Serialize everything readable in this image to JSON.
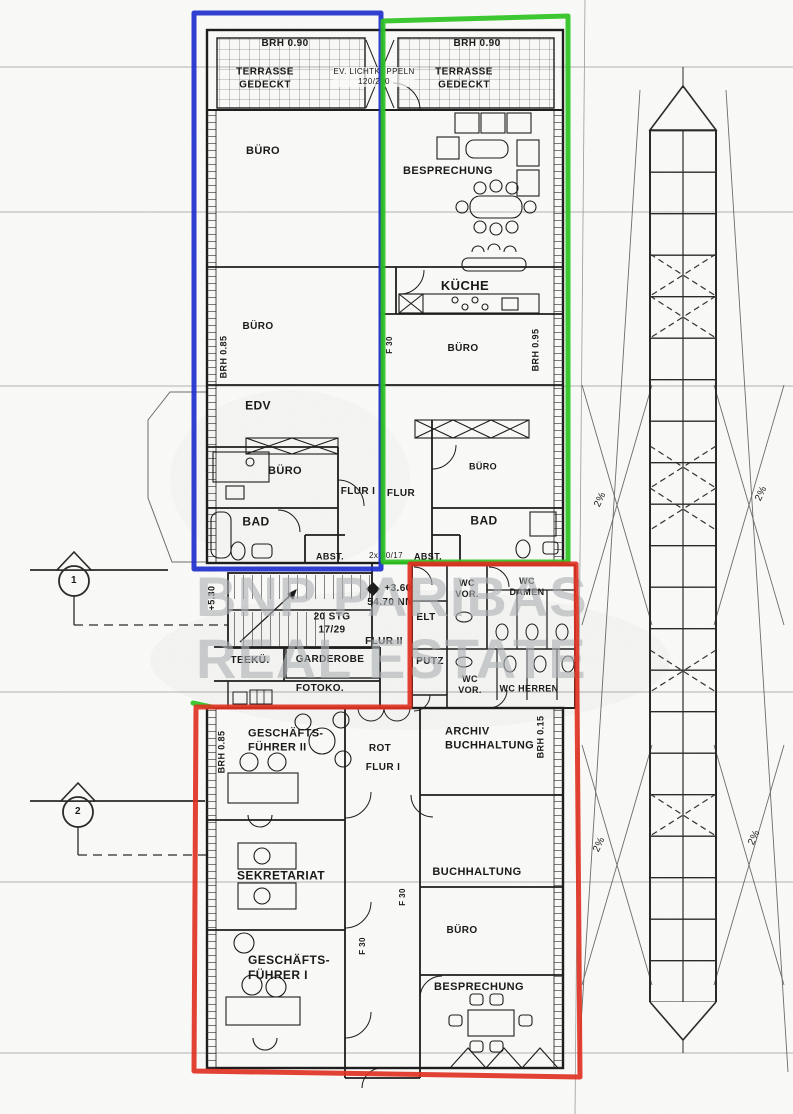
{
  "watermark": {
    "line1": "BNP PARIBAS",
    "line2": "REAL ESTATE"
  },
  "colors": {
    "annotation_blue": "#1f2fcc",
    "annotation_green": "#2cc31f",
    "annotation_red": "#e03222",
    "ink": "#1d1d1d",
    "watermark_gray": "#aeb2b5"
  },
  "top_terraces": {
    "brh_left": "BRH 0.90",
    "brh_right": "BRH 0.90",
    "terrasse_left": "TERRASSE\nGEDECKT",
    "terrasse_right": "TERRASSE\nGEDECKT",
    "lichtkuppeln": "EV. LICHTKUPPELN\n120/240"
  },
  "unit_blue": {
    "buero_1": "BÜRO",
    "buero_2": "BÜRO",
    "edv": "EDV",
    "buero_3": "BÜRO",
    "flur": "FLUR I",
    "bad": "BAD",
    "abst": "ABST.",
    "brh_side": "BRH 0.85"
  },
  "unit_green": {
    "besprechung": "BESPRECHUNG",
    "kueche": "KÜCHE",
    "buero_1": "BÜRO",
    "buero_2": "BÜRO",
    "flur": "FLUR",
    "bad": "BAD",
    "abst": "ABST.",
    "brh_side": "BRH 0.95",
    "f30": "F 30",
    "dim_note": "2x 30/17"
  },
  "core": {
    "stairs": "20 STG\n17/29",
    "level": "+3.60",
    "datum": "54.70 NN",
    "level_side": "+5.30",
    "flur": "FLUR II",
    "teekueche": "TEEKÜ.",
    "garderobe": "GARDEROBE",
    "fotokopierer": "FOTOKO.",
    "wc_vor_top": "WC\nVOR.",
    "wc_damen": "WC\nDAMEN",
    "elt": "ELT",
    "putz": "PUTZ",
    "wc_vor_bottom": "WC\nVOR.",
    "wc_herren": "WC HERREN"
  },
  "unit_red": {
    "geschaeftsfuehrer_2": "GESCHÄFTS-\nFÜHRER II",
    "rot": "ROT",
    "flur": "FLUR I",
    "archiv": "ARCHIV\nBUCHHALTUNG",
    "brh_right": "BRH 0.15",
    "brh_left": "BRH 0.85",
    "sekretariat": "SEKRETARIAT",
    "buchhaltung": "BUCHHALTUNG",
    "f30_a": "F 30",
    "f30_b": "F 30",
    "geschaeftsfuehrer_1": "GESCHÄFTS-\nFÜHRER I",
    "buero": "BÜRO",
    "besprechung": "BESPRECHUNG"
  },
  "site": {
    "slope_1": "2%",
    "slope_2": "2%",
    "slope_3": "2%",
    "slope_4": "2%",
    "section_marker_1": "1",
    "section_marker_2": "2"
  }
}
